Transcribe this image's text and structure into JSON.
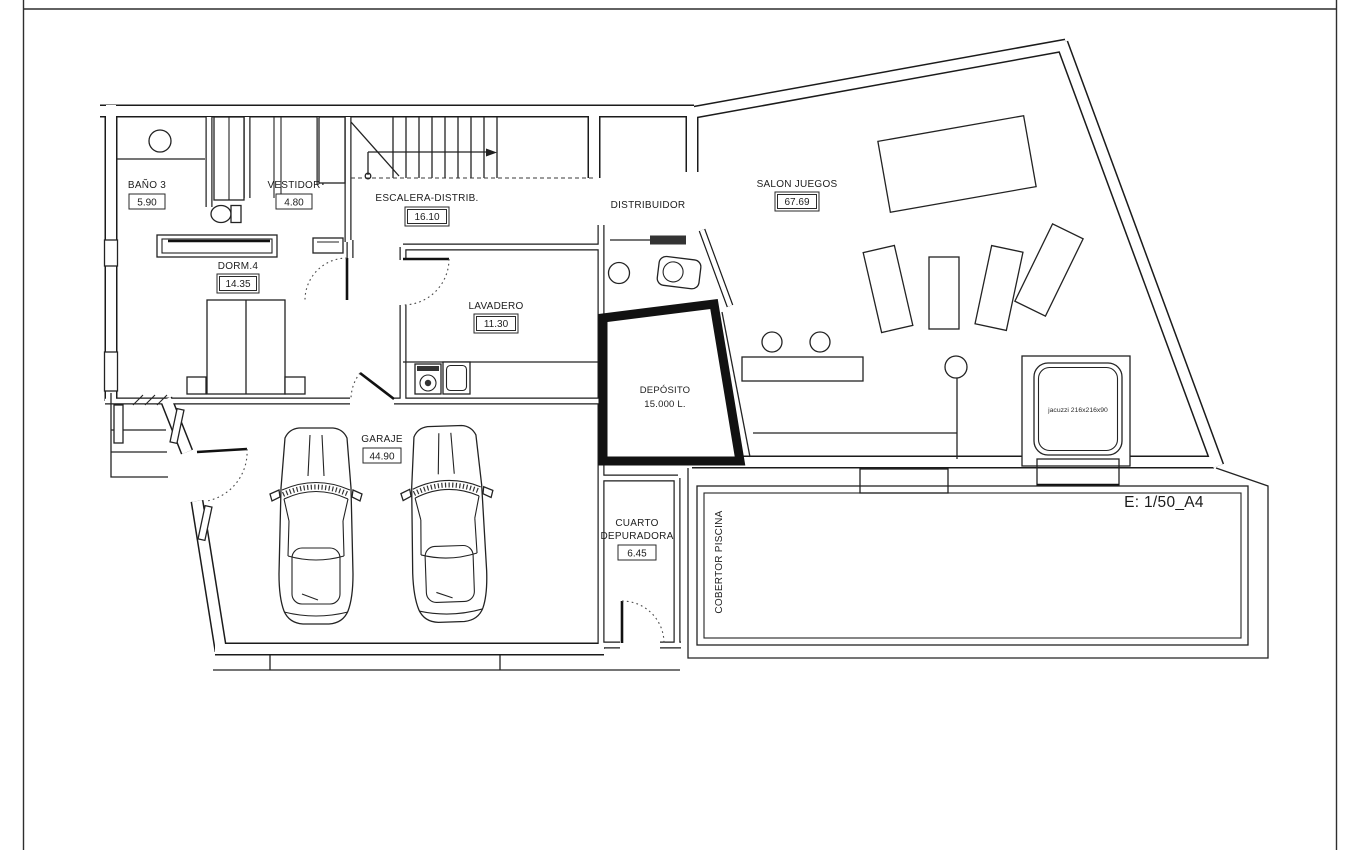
{
  "title_block": {
    "scale_label": "E: 1/50_A4"
  },
  "rooms": {
    "bano3": {
      "name": "BAÑO 3",
      "area": "5.90"
    },
    "vestidor": {
      "name": "VESTIDOR",
      "area": "4.80"
    },
    "escalera": {
      "name": "ESCALERA-DISTRIB.",
      "area": "16.10"
    },
    "distribuidor": {
      "name": "DISTRIBUIDOR"
    },
    "salon_juegos": {
      "name": "SALON JUEGOS",
      "area": "67.69"
    },
    "dorm4": {
      "name": "DORM.4",
      "area": "14.35"
    },
    "lavadero": {
      "name": "LAVADERO",
      "area": "11.30"
    },
    "deposito": {
      "name": "DEPÓSITO",
      "capacity": "15.000 L."
    },
    "garaje": {
      "name": "GARAJE",
      "area": "44.90"
    },
    "cuarto_depuradora": {
      "name_line1": "CUARTO",
      "name_line2": "DEPURADORA",
      "area": "6.45"
    },
    "cobertor_piscina": {
      "name": "COBERTOR PISCINA"
    }
  },
  "annotations": {
    "jacuzzi_label": "jacuzzi 216x216x90"
  },
  "colors": {
    "ink": "#1b1b1b",
    "paper": "#ffffff"
  }
}
